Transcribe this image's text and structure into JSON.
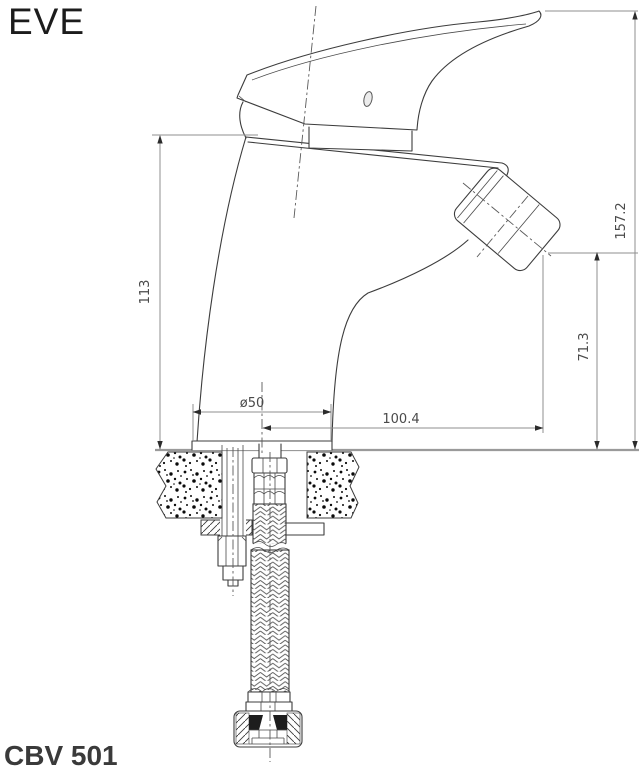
{
  "header": {
    "brand": "EVE"
  },
  "footer": {
    "model": "CBV 501"
  },
  "drawing": {
    "kind": "technical-drawing",
    "subject": "single-lever bidet mixer, side elevation with mounting hardware and flexible braided hose",
    "units_implied": "mm",
    "dimensions": [
      {
        "name": "overall-height",
        "value": "157.2"
      },
      {
        "name": "body-height",
        "value": "113"
      },
      {
        "name": "outlet-height",
        "value": "71.3"
      },
      {
        "name": "base-diameter",
        "value": "ø50"
      },
      {
        "name": "spout-reach",
        "value": "100.4"
      }
    ],
    "colors": {
      "background": "#ffffff",
      "outline": "#3c3c3c",
      "dimension_line": "#8f8f8f",
      "dimension_text": "#4a4a4a",
      "brand_text": "#1c1c1c",
      "model_text": "#3a3a3a"
    }
  }
}
